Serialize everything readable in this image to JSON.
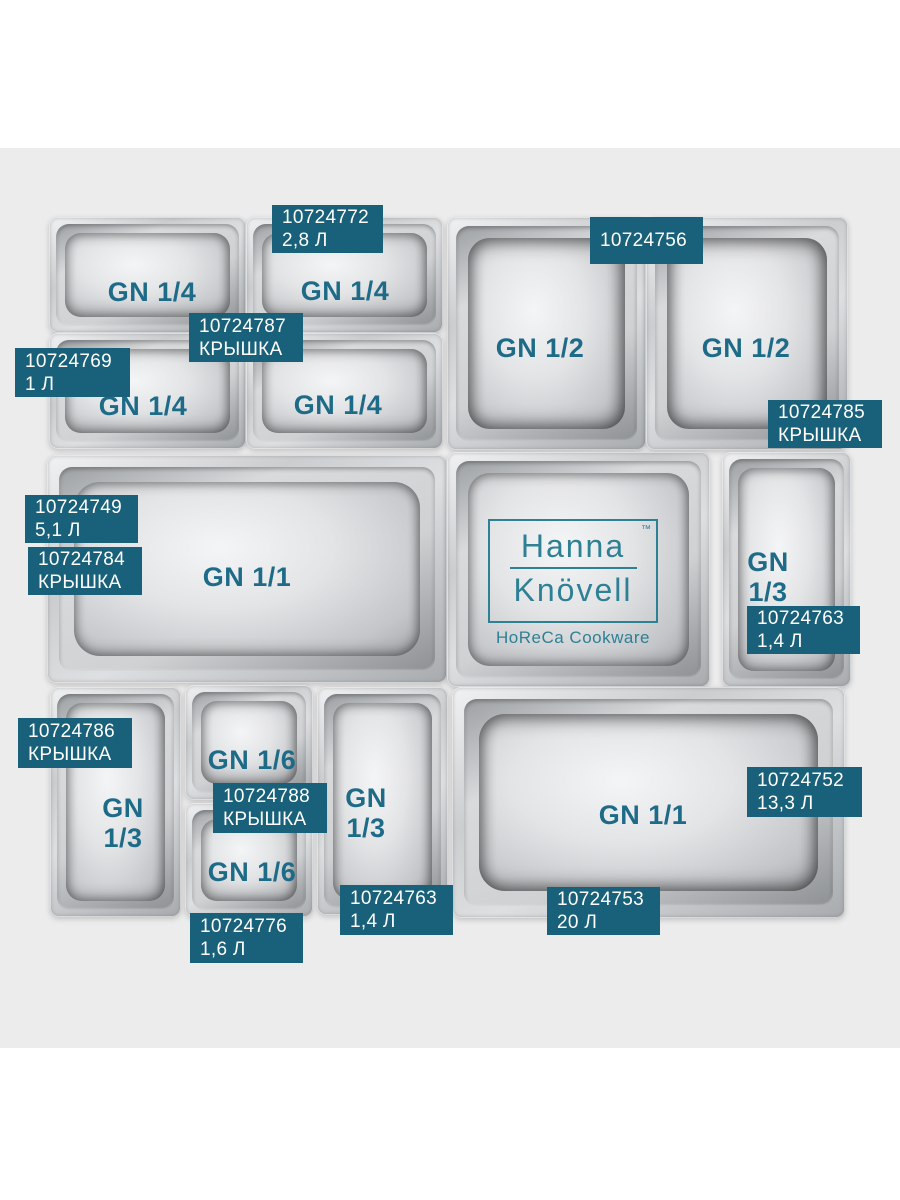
{
  "page": {
    "background": "#ffffff",
    "band_color": "#ececec"
  },
  "colors": {
    "badge_bg": "#19617a",
    "badge_text": "#ffffff",
    "gn_label": "#1e6b88",
    "logo_teal": "#2e8094",
    "pan_metal": "#c9cbcd"
  },
  "logo": {
    "line1": "Hanna",
    "line2": "Knövell",
    "tm": "™",
    "tagline": "HoReCa Cookware"
  },
  "pans": [
    {
      "id": "gn14-top-left",
      "label": "GN 1/4"
    },
    {
      "id": "gn14-top-right",
      "label": "GN 1/4"
    },
    {
      "id": "gn14-row2-left",
      "label": "GN 1/4"
    },
    {
      "id": "gn14-row2-right",
      "label": "GN 1/4"
    },
    {
      "id": "gn12-left",
      "label": "GN 1/2"
    },
    {
      "id": "gn12-right",
      "label": "GN 1/2"
    },
    {
      "id": "gn11-middle",
      "label": "GN 1/1"
    },
    {
      "id": "logo-pan",
      "label": ""
    },
    {
      "id": "gn13-middle-right",
      "label": "GN\n1/3"
    },
    {
      "id": "gn13-bottom-left",
      "label": "GN\n1/3"
    },
    {
      "id": "gn16-top",
      "label": "GN 1/6"
    },
    {
      "id": "gn16-bottom",
      "label": "GN 1/6"
    },
    {
      "id": "gn13-bottom-mid",
      "label": "GN\n1/3"
    },
    {
      "id": "gn11-bottom",
      "label": "GN 1/1"
    }
  ],
  "badges": [
    {
      "code": "10724772",
      "label2": "2,8 Л"
    },
    {
      "code": "10724756",
      "label2": ""
    },
    {
      "code": "10724787",
      "label2": "КРЫШКА"
    },
    {
      "code": "10724769",
      "label2": "1 Л"
    },
    {
      "code": "10724785",
      "label2": "КРЫШКА"
    },
    {
      "code": "10724749",
      "label2": "5,1 Л"
    },
    {
      "code": "10724784",
      "label2": "КРЫШКА"
    },
    {
      "code": "10724763",
      "label2": "1,4 Л"
    },
    {
      "code": "10724786",
      "label2": "КРЫШКА"
    },
    {
      "code": "10724788",
      "label2": "КРЫШКА"
    },
    {
      "code": "10724752",
      "label2": "13,3 Л"
    },
    {
      "code": "10724763",
      "label2": "1,4 Л"
    },
    {
      "code": "10724776",
      "label2": "1,6 Л"
    },
    {
      "code": "10724753",
      "label2": "20 Л"
    }
  ]
}
